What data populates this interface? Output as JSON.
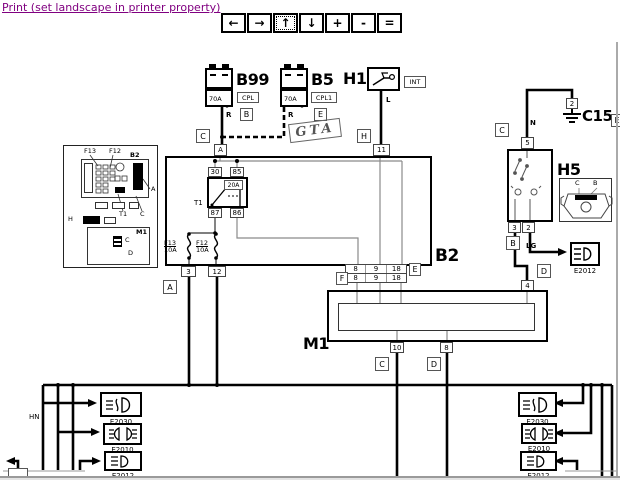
{
  "header": {
    "print_link": "Print (set landscape in printer property)"
  },
  "toolbar": {
    "buttons": [
      {
        "name": "pan-left",
        "glyph": "←"
      },
      {
        "name": "pan-right",
        "glyph": "→"
      },
      {
        "name": "pan-up",
        "glyph": "↑"
      },
      {
        "name": "pan-down",
        "glyph": "↓"
      },
      {
        "name": "zoom-in",
        "glyph": "+"
      },
      {
        "name": "zoom-out",
        "glyph": "-"
      },
      {
        "name": "zoom-fit",
        "glyph": "="
      }
    ]
  },
  "colors": {
    "link": "#800080",
    "wire": "#000000",
    "thin_wire": "#8a8a8a"
  },
  "diagram": {
    "b99": {
      "label": "B99",
      "fuse": "70A",
      "tag": "CPL",
      "letter": "B",
      "wire": "R"
    },
    "b5": {
      "label": "B5",
      "fuse": "70A",
      "tag": "CPL1",
      "letter": "E",
      "wire": "R"
    },
    "badge": "GTA",
    "h1": {
      "label": "H1",
      "tag": "INT",
      "wire": "L",
      "letter": "H",
      "pin": "11"
    },
    "b2": {
      "label": "B2",
      "letter_top": "C",
      "pin_top": "A",
      "relay": {
        "label": "T1",
        "fuse": "20A",
        "pin_30": "30",
        "pin_85": "85",
        "pin_87": "87",
        "pin_86": "86"
      },
      "fuse_f13": {
        "name": "F13",
        "rating": "10A"
      },
      "fuse_f12": {
        "name": "F12",
        "rating": "10A"
      },
      "pin_3": "3",
      "pin_12": "12",
      "letter_a": "A",
      "pins_e": [
        "8",
        "9",
        "18"
      ],
      "letter_e": "E"
    },
    "m1": {
      "label": "M1",
      "pins_f": [
        "8",
        "9",
        "18"
      ],
      "letter_f": "F",
      "pin_4": "4",
      "letter_d_right": "D",
      "pin_10": "10",
      "pin_8": "8",
      "letter_c": "C",
      "letter_d": "D"
    },
    "h5": {
      "label": "H5",
      "letter_c": "C",
      "wire_n": "N",
      "pin_5": "5",
      "pin_3": "3",
      "pin_2": "2",
      "letter_b": "B",
      "wire_lg": "LG",
      "inset_c": "C",
      "inset_b": "B"
    },
    "c15": {
      "pin": "2",
      "label": "C15",
      "edge_letter": "E"
    },
    "e2012_right": {
      "label": "E2012"
    },
    "lamps_left": [
      {
        "label": "E2030"
      },
      {
        "label": "E2010"
      },
      {
        "label": "E2012"
      }
    ],
    "lamps_right": [
      {
        "label": "E2030"
      },
      {
        "label": "E2010"
      },
      {
        "label": "E2012"
      }
    ],
    "wire_hn": "HN",
    "inset": {
      "f13": "F13",
      "f12": "F12",
      "b2": "B2",
      "a": "A",
      "t1": "T1",
      "c": "C",
      "h": "H",
      "m1": "M1",
      "c2": "C",
      "d": "D"
    }
  }
}
